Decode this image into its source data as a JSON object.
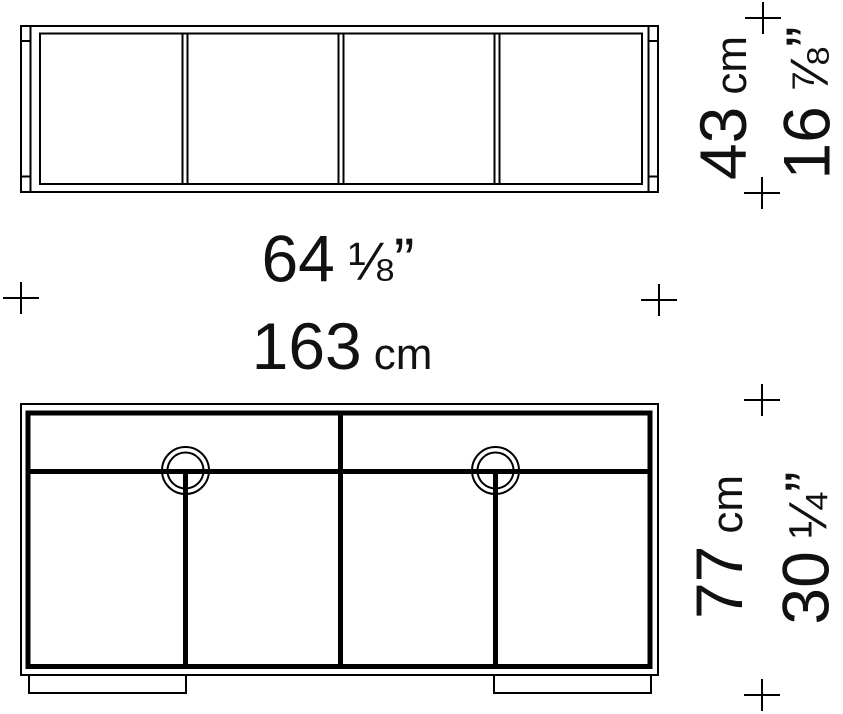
{
  "dimensions": {
    "width": {
      "cm": "163",
      "inches": "64",
      "fraction": "⅛"
    },
    "depth": {
      "cm": "43",
      "inches": "16",
      "fraction": "⅞"
    },
    "height": {
      "cm": "77",
      "inches": "30",
      "fraction": "¼"
    }
  },
  "units": {
    "cm": "cm",
    "inch_mark": "”"
  },
  "colors": {
    "line": "#000000",
    "text": "#111111",
    "background": "#ffffff"
  }
}
